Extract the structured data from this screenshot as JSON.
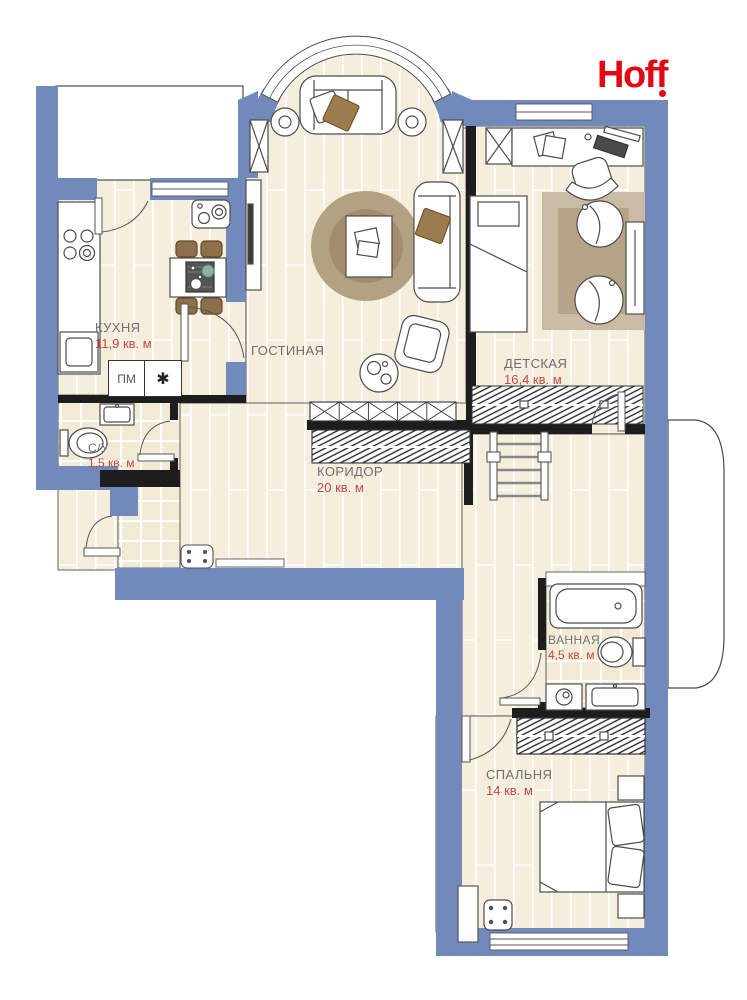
{
  "logo": {
    "text": "Hoff"
  },
  "rooms": {
    "kitchen": {
      "name": "КУХНЯ",
      "area": "11,9 кв. м"
    },
    "living": {
      "name": "ГОСТИНАЯ",
      "area": "23,2 кв. м"
    },
    "kids": {
      "name": "ДЕТСКАЯ",
      "area": "16,4 кв. м"
    },
    "corridor": {
      "name": "КОРИДОР",
      "area": "20 кв. м"
    },
    "wc": {
      "name": "С/У",
      "area": "1,5 кв. м"
    },
    "bath": {
      "name": "ВАННАЯ",
      "area": "4,5 кв. м"
    },
    "bedroom": {
      "name": "СПАЛЬНЯ",
      "area": "14 кв. м"
    }
  },
  "appliances": {
    "washing_machine_label": "ПМ",
    "builtin_label": "✱"
  },
  "colors": {
    "wall": "#7289bb",
    "floor": "#f5eedd",
    "accent_red": "#c4493f",
    "logo_red": "#e30613"
  }
}
